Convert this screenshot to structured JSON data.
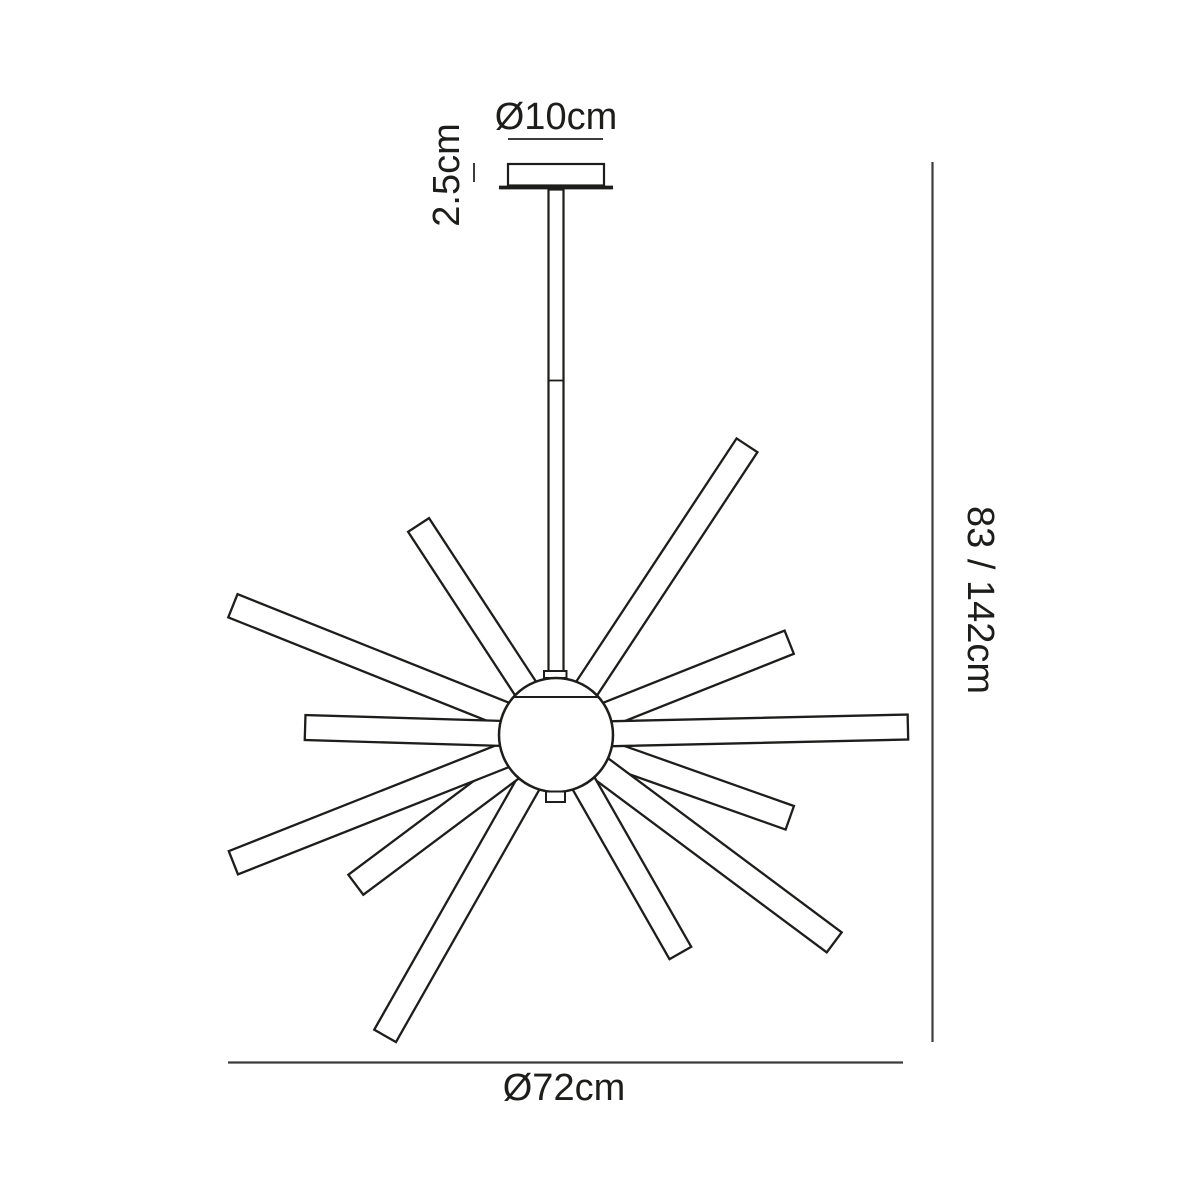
{
  "colors": {
    "background": "#ffffff",
    "drawing_line": "#1d1d1b",
    "dimension_line": "#3c3c3c",
    "text": "#1d1d1b"
  },
  "labels": {
    "canopy_diameter": "Ø10cm",
    "canopy_height": "2.5cm",
    "overall_height": "83 / 142cm",
    "fixture_diameter": "Ø72cm"
  },
  "sphere": {
    "cx": 556,
    "cy": 735,
    "r": 57
  },
  "arm_width": 25,
  "arm_inner_offset": 28,
  "arms": [
    {
      "name": "arm-upper-right-steep",
      "angle": -56.6,
      "length": 347
    },
    {
      "name": "arm-upper-left-steep",
      "angle": -123.2,
      "length": 251
    },
    {
      "name": "arm-upper-right-mid",
      "angle": -21.7,
      "length": 251
    },
    {
      "name": "arm-upper-left-shallow",
      "angle": -158.2,
      "length": 348
    },
    {
      "name": "arm-lower-right-shallow",
      "angle": 19.5,
      "length": 248
    },
    {
      "name": "arm-lower-right-mid",
      "angle": 36.7,
      "length": 347
    },
    {
      "name": "arm-lower-right-steep",
      "angle": 60.3,
      "length": 251
    },
    {
      "name": "arm-lower-left-steep",
      "angle": 119.6,
      "length": 346
    },
    {
      "name": "arm-lower-left-mid",
      "angle": 143.2,
      "length": 250
    },
    {
      "name": "arm-lower-left-shallow",
      "angle": 158.4,
      "length": 347
    },
    {
      "name": "arm-right-horizontal",
      "angle": -1.3,
      "length": 352
    },
    {
      "name": "arm-left-horizontal",
      "angle": 181.7,
      "length": 251
    }
  ]
}
